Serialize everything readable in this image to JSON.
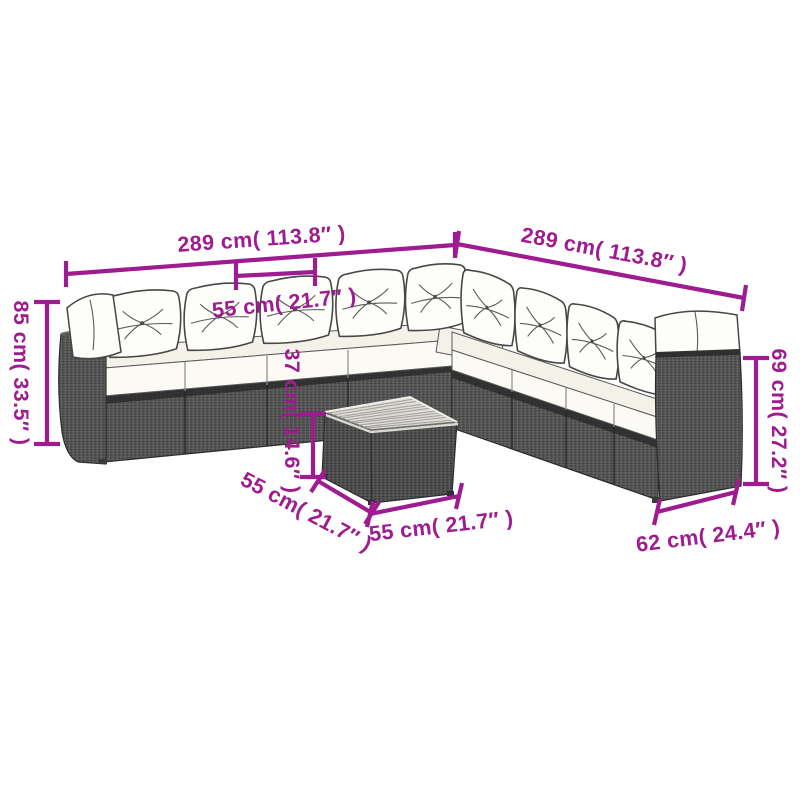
{
  "figure": {
    "type": "product-dimension-diagram",
    "subject": "rattan garden corner sofa set with cushions and square coffee table",
    "background_color": "#ffffff",
    "accent_color": "#9E1B90",
    "wicker_color": "#565656",
    "cushion_color": "#fdfdfa",
    "table_top_color": "#dfddd8"
  },
  "dims": {
    "left_total": "289 cm( 113.8″ )",
    "right_total": "289 cm( 113.8″ )",
    "seat_module": "55 cm( 21.7″ )",
    "back_height": "85 cm( 33.5″ )",
    "table_height": "37 cm( 14.6″ )",
    "table_depth": "55 cm( 21.7″ )",
    "table_width": "55 cm( 21.7″ )",
    "arm_height": "69 cm( 27.2″ )",
    "seat_depth": "62 cm( 24.4″ )"
  }
}
